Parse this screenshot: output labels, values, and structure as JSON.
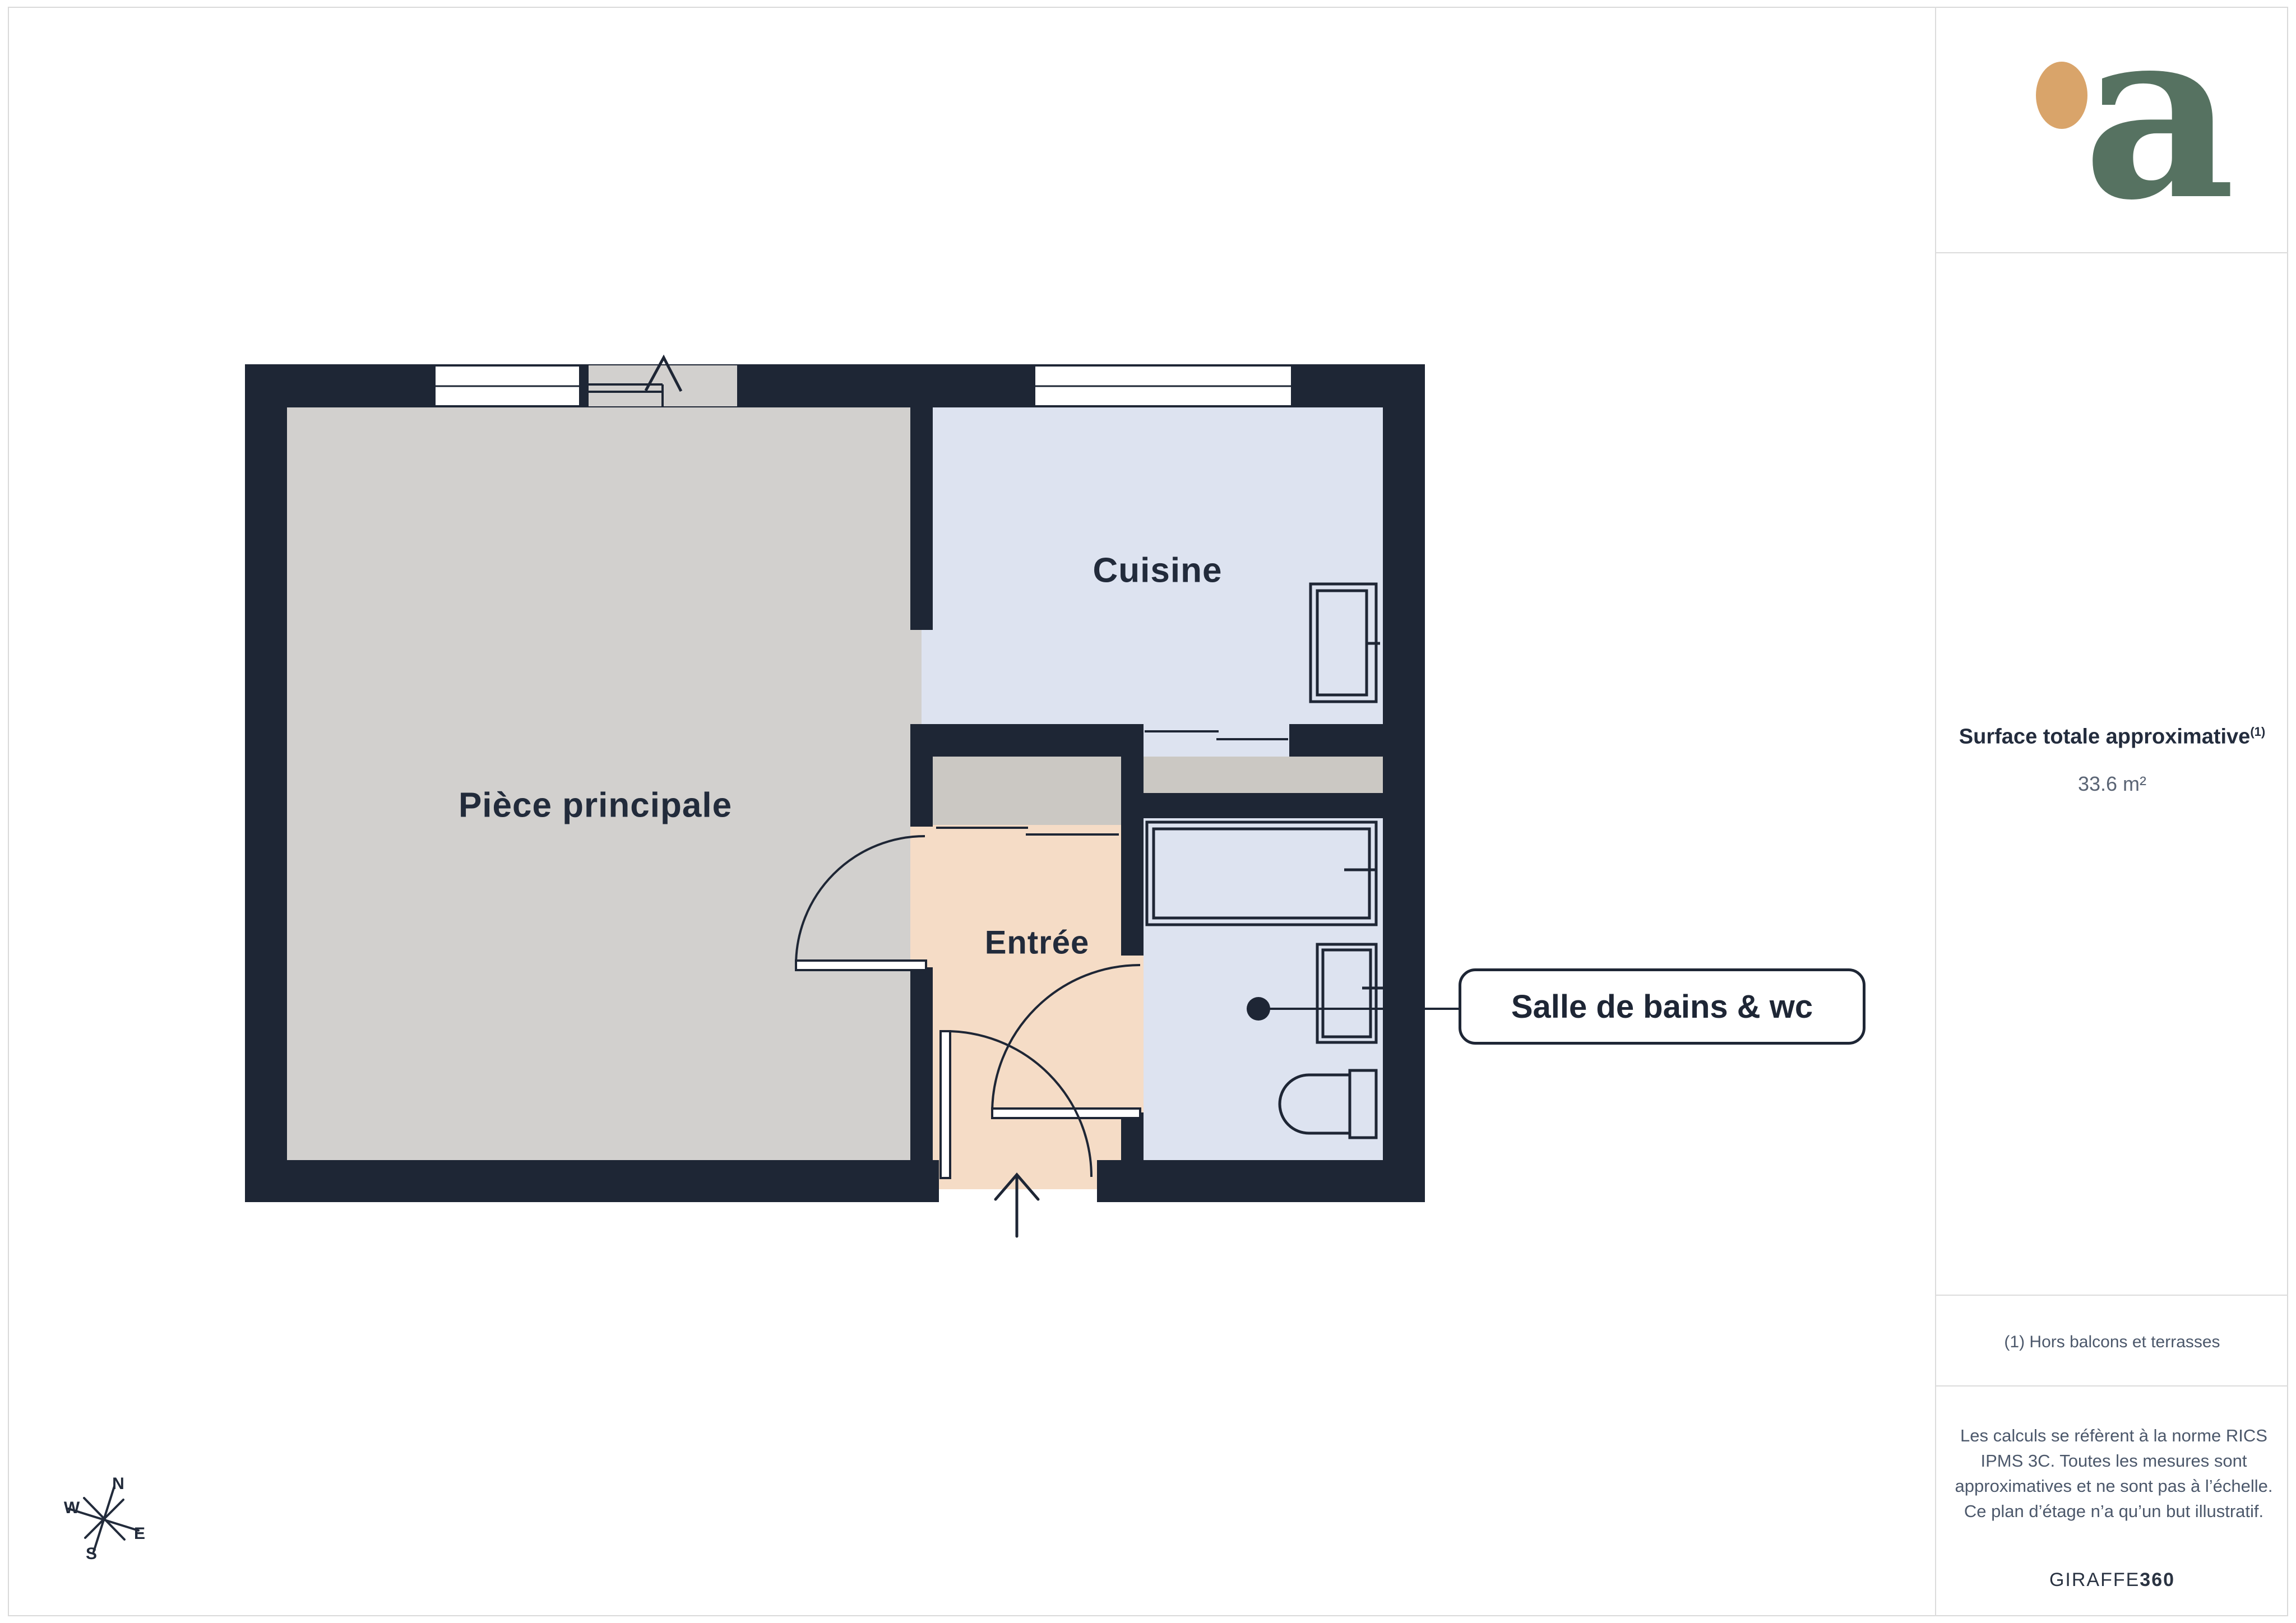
{
  "plan": {
    "rooms": [
      {
        "id": "piece-principale",
        "label": "Pièce principale"
      },
      {
        "id": "cuisine",
        "label": "Cuisine"
      },
      {
        "id": "entree",
        "label": "Entrée"
      }
    ],
    "callout": {
      "label": "Salle de bains & wc"
    }
  },
  "compass": {
    "north": "N",
    "east": "E",
    "south": "S",
    "west": "W"
  },
  "sidebar": {
    "logo_letter": "a",
    "surface": {
      "title": "Surface totale approximative",
      "superscript": "(1)",
      "value": "33.6 m²"
    },
    "footnote": "(1) Hors balcons et terrasses",
    "disclaimer": "Les calculs se réfèrent à la norme RICS IPMS 3C. Toutes les mesures sont approximatives et ne sont pas à l’échelle. Ce plan d’étage n’a qu’un but illustratif.",
    "brand": {
      "name": "GIRAFFE",
      "suffix": "360"
    }
  },
  "colors": {
    "wall": "#1e2635",
    "floor_main": "#d2d0ce",
    "floor_wet": "#dde3f0",
    "floor_entry": "#f5dcc6",
    "floor_closet": "#cbc8c3",
    "logo_green": "#567261",
    "logo_dot": "#d9a46a",
    "text_dark": "#222b3b",
    "text_muted": "#4c586b",
    "divider": "#dcdcdc"
  }
}
